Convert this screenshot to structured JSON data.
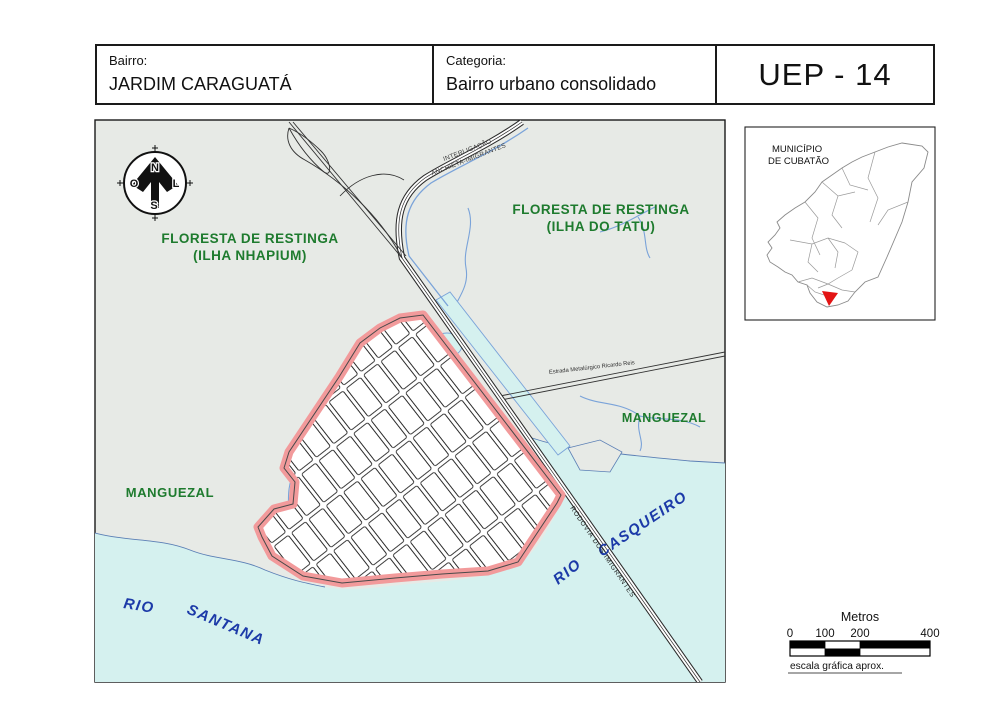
{
  "header": {
    "bairro_label": "Bairro:",
    "bairro_value": "JARDIM CARAGUATÁ",
    "categoria_label": "Categoria:",
    "categoria_value": "Bairro urbano consolidado",
    "uep_code": "UEP - 14"
  },
  "map": {
    "labels": {
      "floresta_nhapium_1": "FLORESTA DE RESTINGA",
      "floresta_nhapium_2": "(ILHA NHAPIUM)",
      "floresta_tatu_1": "FLORESTA DE RESTINGA",
      "floresta_tatu_2": "(ILHA DO TATU)",
      "interligacao_1": "INTERLIGAÇÃO",
      "interligacao_2": "ANCHIETA-IMIGRANTES",
      "manguezal_left": "MANGUEZAL",
      "manguezal_right": "MANGUEZAL",
      "rio_santana_1": "RIO",
      "rio_santana_2": "SANTANA",
      "rio_casqueiro_1": "RIO",
      "rio_casqueiro_2": "CASQUEIRO",
      "rodovia_imigrantes": "RODOVIA  DOS IMIGRANTES",
      "estrada": "Estrada Metalúrgico Ricardo Reis"
    },
    "compass": {
      "north": "N",
      "south": "S",
      "east": "L",
      "west": "O"
    }
  },
  "inset": {
    "title_1": "MUNICÍPIO",
    "title_2": "DE CUBATÃO"
  },
  "scale_bar": {
    "title": "Metros",
    "ticks": [
      "0",
      "100",
      "200",
      "400"
    ],
    "caption": "escala gráfica aprox."
  },
  "colors": {
    "land": "#e7eae6",
    "water": "#d5f1ef",
    "boundary_pink": "#f29a9b",
    "forest_green": "#1e7b2e",
    "river_blue": "#1c3aa8",
    "highlight_red": "#e31414",
    "stream_blue": "#7aa3d9"
  }
}
